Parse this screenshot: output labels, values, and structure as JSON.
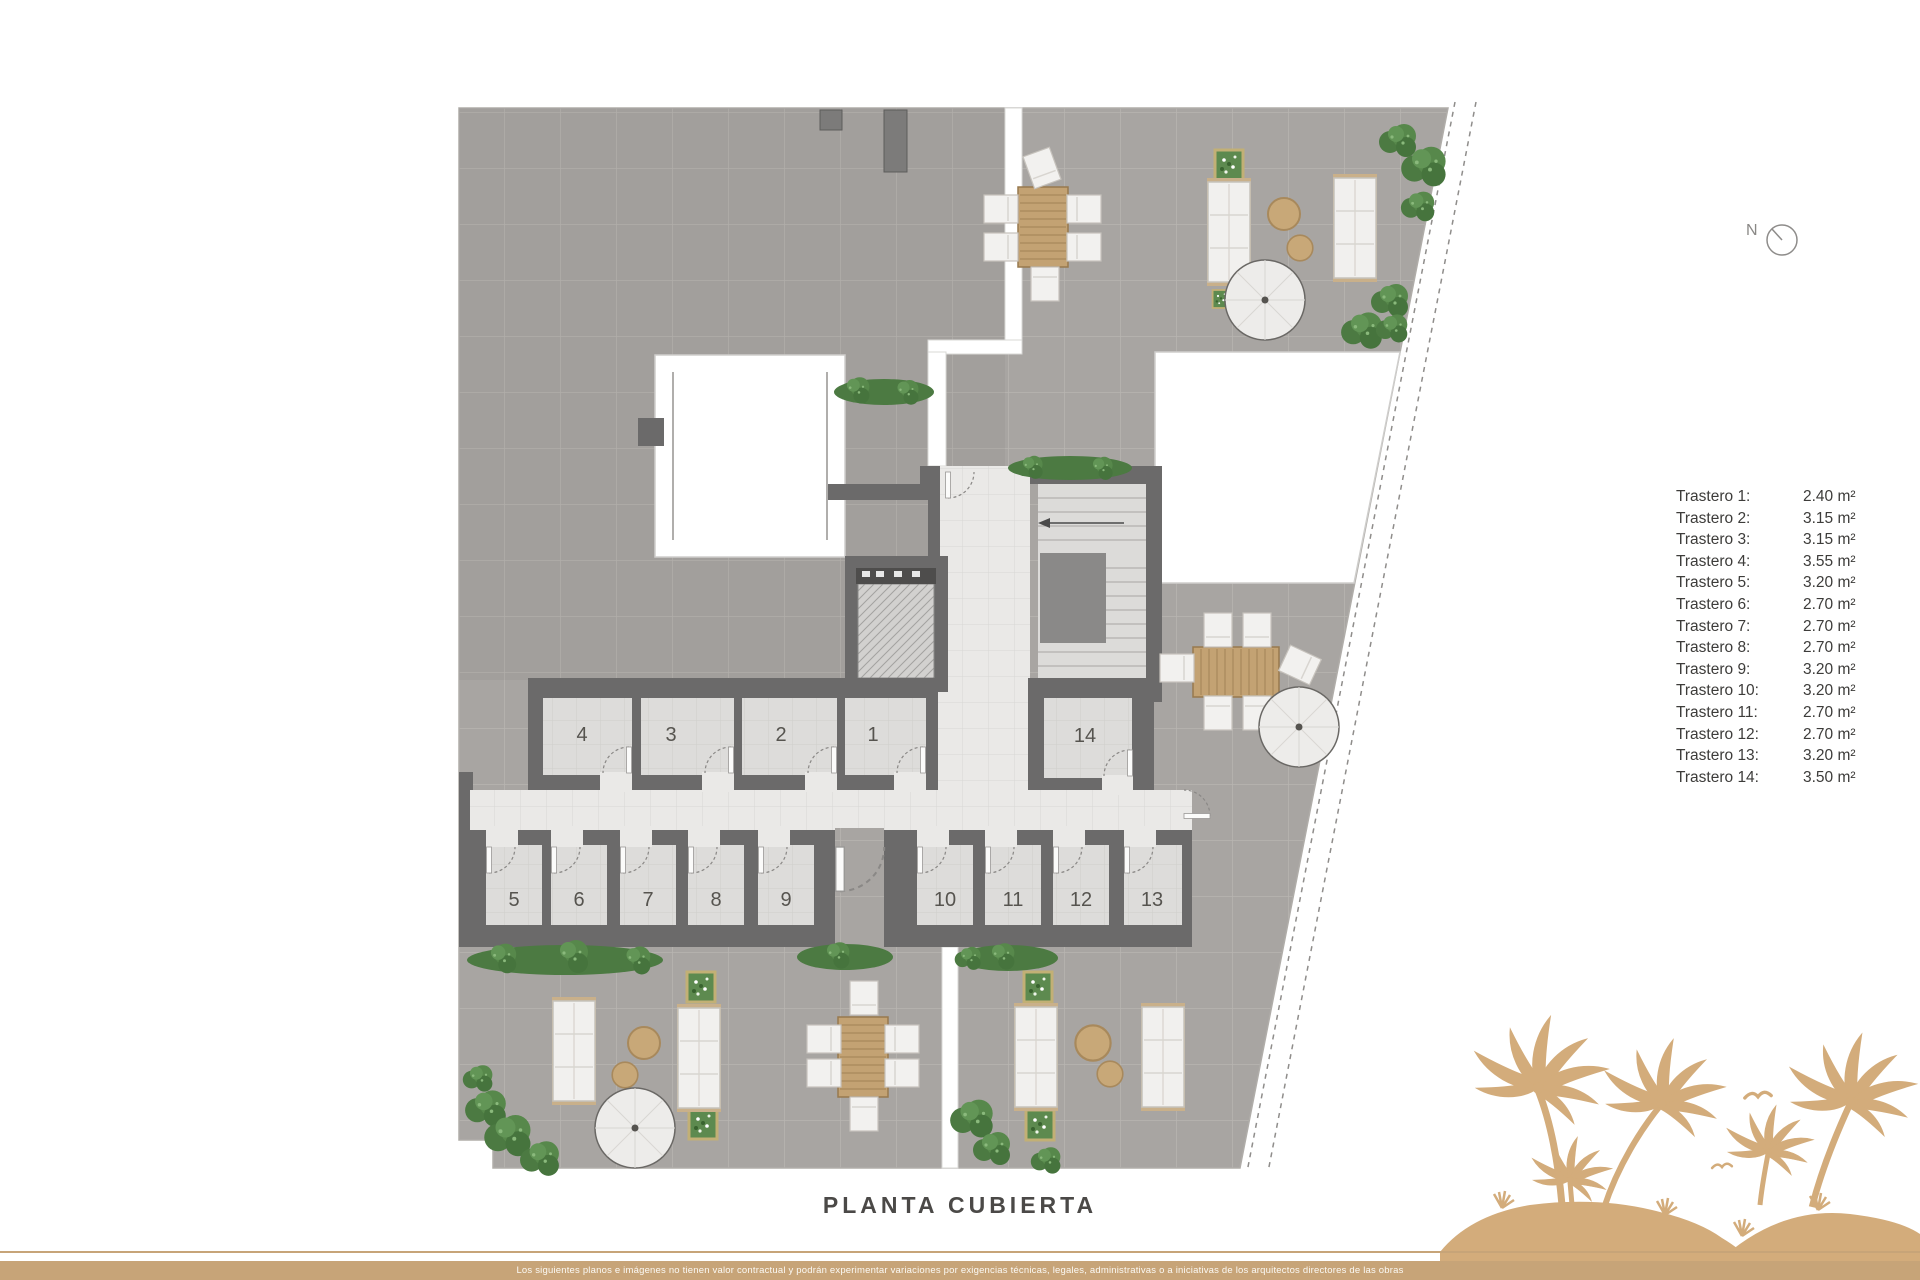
{
  "header": {
    "compass_label": "N"
  },
  "plan": {
    "title": "PLANTA CUBIERTA",
    "room_labels": [
      "1",
      "2",
      "3",
      "4",
      "5",
      "6",
      "7",
      "8",
      "9",
      "10",
      "11",
      "12",
      "13",
      "14"
    ]
  },
  "legend": {
    "items": [
      {
        "label": "Trastero 1:",
        "value": "2.40 m²"
      },
      {
        "label": "Trastero 2:",
        "value": "3.15 m²"
      },
      {
        "label": "Trastero 3:",
        "value": "3.15 m²"
      },
      {
        "label": "Trastero 4:",
        "value": "3.55 m²"
      },
      {
        "label": "Trastero 5:",
        "value": "3.20 m²"
      },
      {
        "label": "Trastero 6:",
        "value": "2.70 m²"
      },
      {
        "label": "Trastero 7:",
        "value": "2.70 m²"
      },
      {
        "label": "Trastero 8:",
        "value": "2.70 m²"
      },
      {
        "label": "Trastero 9:",
        "value": "3.20 m²"
      },
      {
        "label": "Trastero 10:",
        "value": "3.20 m²"
      },
      {
        "label": "Trastero 11:",
        "value": "2.70 m²"
      },
      {
        "label": "Trastero 12:",
        "value": "2.70 m²"
      },
      {
        "label": "Trastero 13:",
        "value": "3.20 m²"
      },
      {
        "label": "Trastero 14:",
        "value": "3.50 m²"
      }
    ]
  },
  "footer": {
    "disclaimer": "Los siguientes planos e imágenes no tienen valor contractual y podrán experimentar variaciones por exigencias técnicas, legales, administrativas o a iniciativas de los arquitectos directores de las obras"
  },
  "colors": {
    "accent_tan": "#c7a478",
    "palm_tan": "#d3ac7b",
    "wall_gray": "#6b6a6a",
    "terrace_gray": "#a8a5a2",
    "plant_green": "#4c7a42"
  }
}
